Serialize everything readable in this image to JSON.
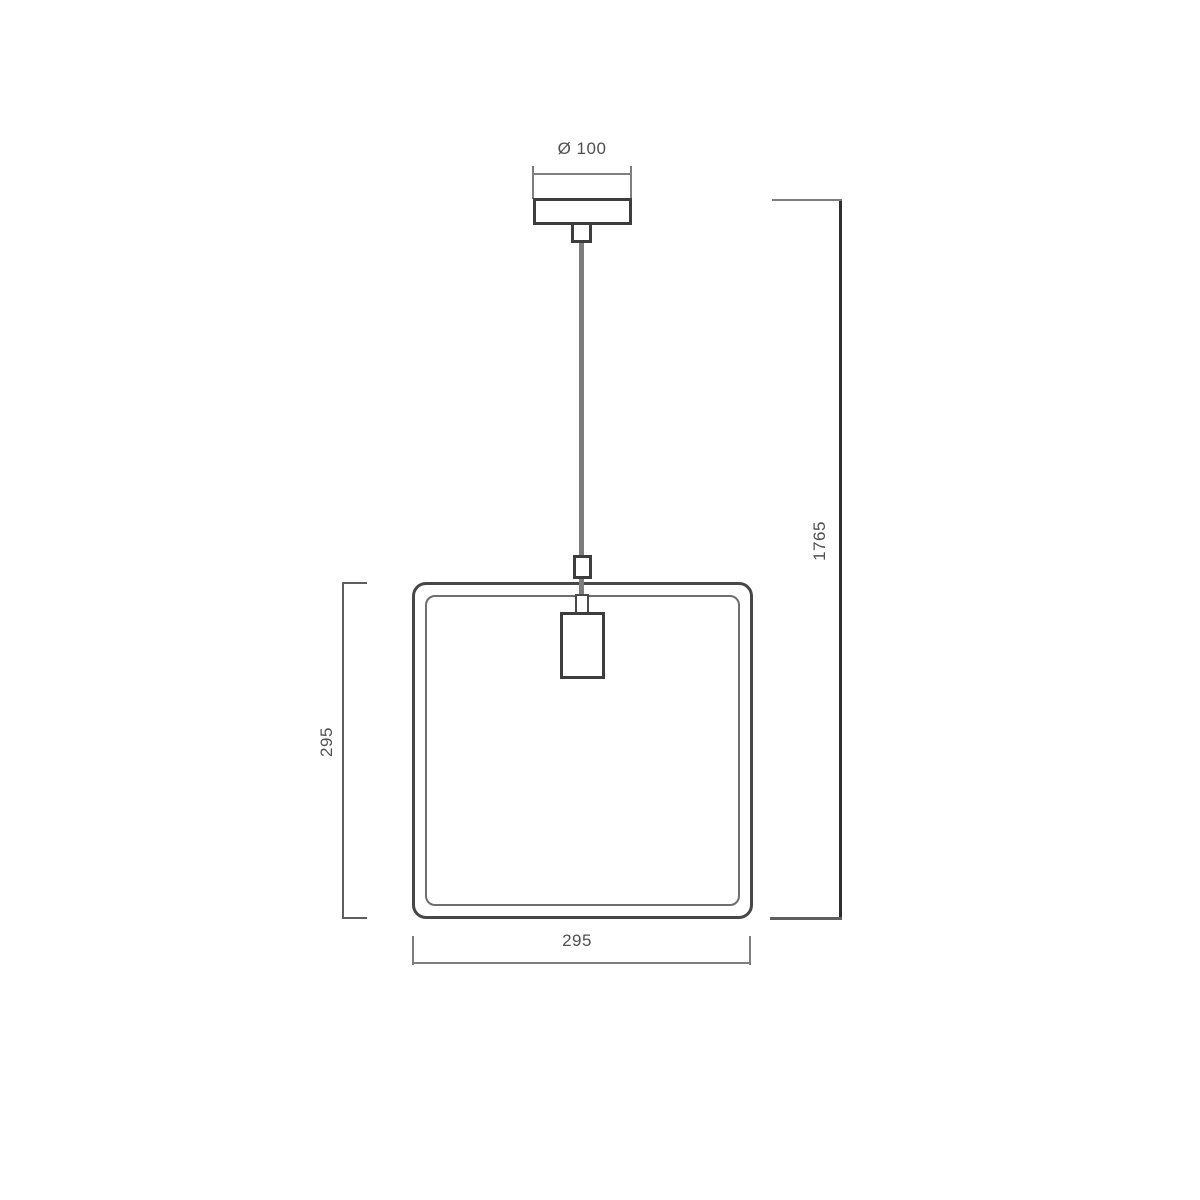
{
  "drawing": {
    "dimensions": {
      "canopy_diameter": "Ø 100",
      "overall_height": "1765",
      "shade_height": "295",
      "shade_width": "295"
    },
    "colors": {
      "background": "#ffffff",
      "object_line": "#3d3d3d",
      "dimension_line": "#7e7e7e",
      "text": "#4f4f4f"
    }
  }
}
